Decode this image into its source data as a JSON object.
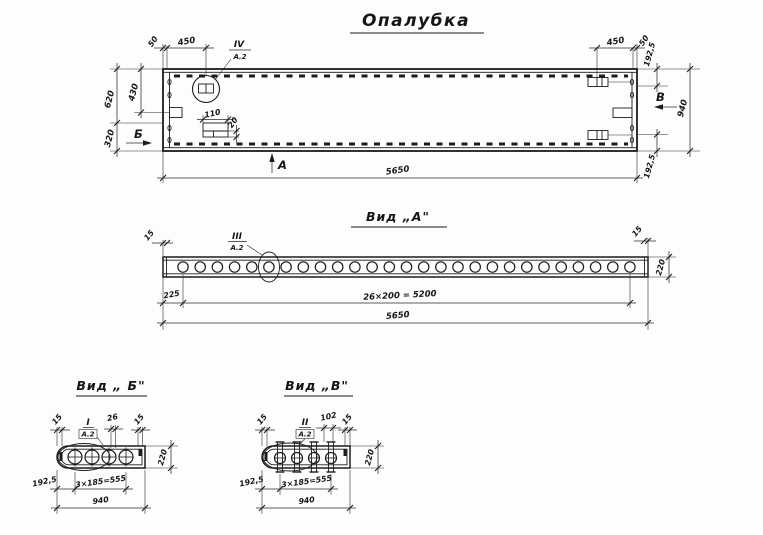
{
  "titles": {
    "main": "Опалубка",
    "view_a": "Вид „А\"",
    "view_b": "Вид „ Б\"",
    "view_v": "Вид „В\""
  },
  "main_view": {
    "callout_roman": "IV",
    "callout_ref": "А.2",
    "dim_left_wall": "50",
    "dim_detail_left": "450",
    "dim_plate_w": "110",
    "dim_plate_h": "20",
    "dim_left_upper": "620",
    "dim_left_mid": "430",
    "dim_left_lower": "320",
    "section_left": "Б",
    "section_bottom": "А",
    "section_right": "В",
    "dim_length": "5650",
    "dim_detail_right": "450",
    "dim_right_wall": "50",
    "dim_right_top": "192,5",
    "dim_right_full": "940",
    "dim_right_bottom": "192,5"
  },
  "view_a": {
    "callout_roman": "III",
    "callout_ref": "А.2",
    "dim_end_left": "15",
    "dim_end_right": "15",
    "dim_height": "220",
    "dim_first": "225",
    "dim_pitch": "26×200 = 5200",
    "dim_length": "5650",
    "holes": 27
  },
  "view_b": {
    "callout_roman": "I",
    "callout_ref": "А.2",
    "dim_end_left": "15",
    "dim_hole": "26",
    "dim_end_right": "15",
    "dim_height": "220",
    "dim_margin": "192,5",
    "dim_pitch": "3×185=555",
    "dim_width": "940",
    "holes": 4
  },
  "view_v": {
    "callout_roman": "II",
    "callout_ref": "А.2",
    "dim_end_left": "15",
    "dim_bolt": "102",
    "dim_end_right": "15",
    "dim_height": "220",
    "dim_margin": "192,5",
    "dim_pitch": "3×185=555",
    "dim_width": "940",
    "holes": 4
  }
}
